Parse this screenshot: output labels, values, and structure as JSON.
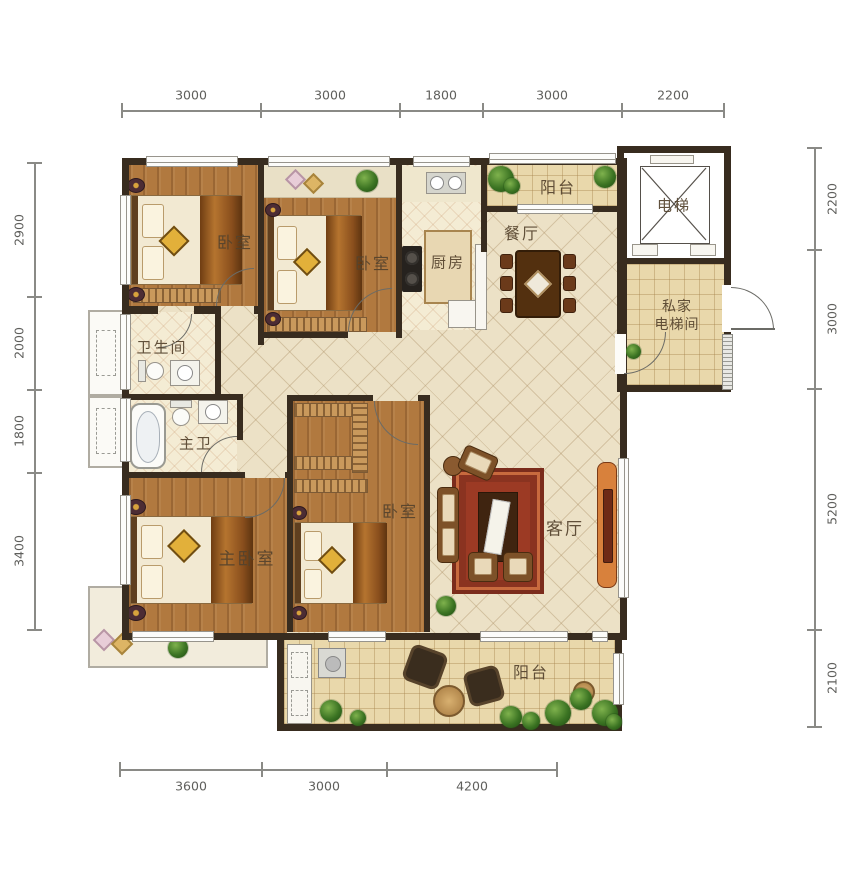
{
  "dims": {
    "top": [
      "3000",
      "3000",
      "1800",
      "3000",
      "2200"
    ],
    "left": [
      "2900",
      "2000",
      "1800",
      "3400"
    ],
    "right": [
      "2200",
      "3000",
      "5200",
      "2100"
    ],
    "bottom": [
      "3600",
      "3000",
      "4200"
    ]
  },
  "rooms": {
    "bedroom1": "卧室",
    "bedroom2": "卧室",
    "bedroom3": "卧室",
    "master_bedroom": "主卧室",
    "kitchen": "厨房",
    "dining": "餐厅",
    "living": "客厅",
    "bathroom": "卫生间",
    "master_bath": "主卫",
    "balcony_top": "阳台",
    "balcony_bottom": "阳台",
    "elevator": "电梯",
    "private_elevator_line1": "私家",
    "private_elevator_line2": "电梯间"
  },
  "colors": {
    "wall": "#382c1f",
    "wood_floor": "#b1793f",
    "tile_floor": "#ece1c6",
    "balcony_floor": "#e9d8ab",
    "rug_red": "#9c3a24"
  }
}
